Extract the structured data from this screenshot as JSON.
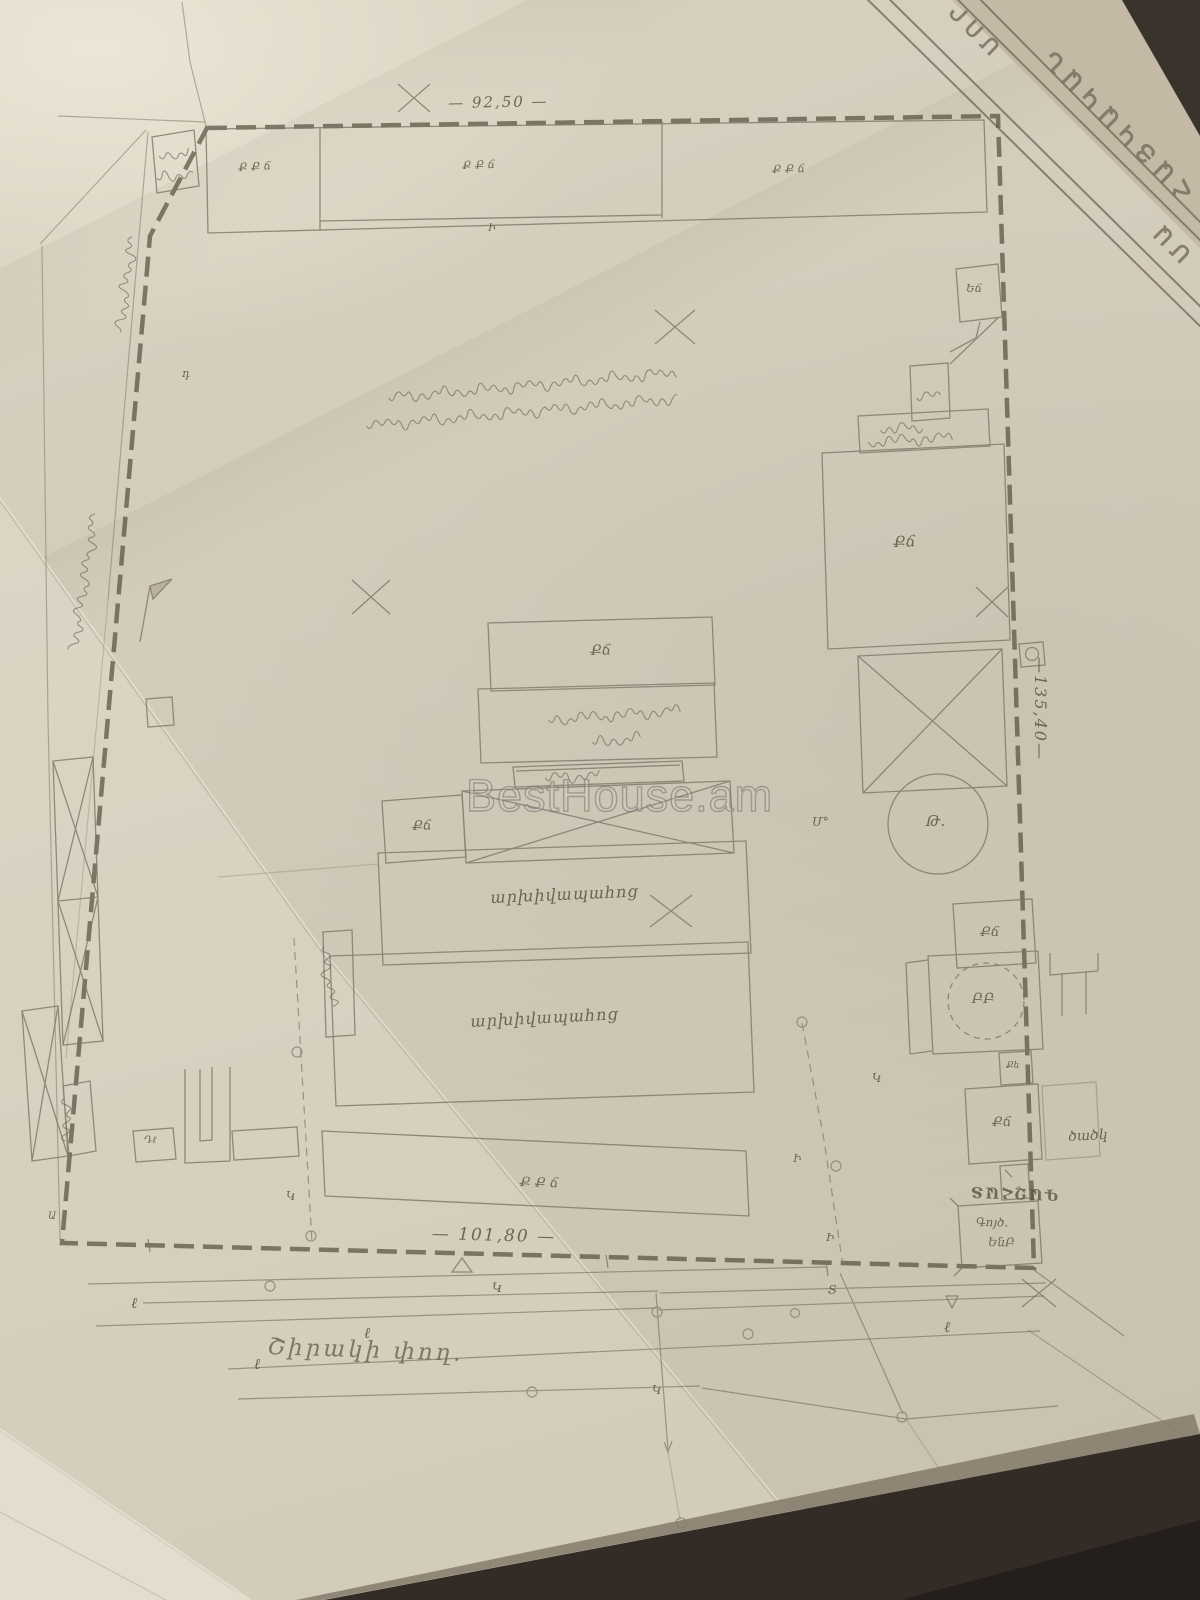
{
  "watermark": "BestHouse.am",
  "stamp_banner": {
    "fragment_top": "ՄՈՐ",
    "fragment_main": "ՀԱՅԿԱԿԱՆ",
    "fragment_edge": "ՄԱ"
  },
  "dimensions": {
    "top": "— 92,50 —",
    "right": "—135,40—",
    "bottom": "— 101,80 —"
  },
  "street_name": "Շիրակի  փող.",
  "plan_labels": {
    "strip_cell_1": "Ք Ք ճ",
    "strip_cell_2": "Ք Ք ճ",
    "strip_cell_3": "Ք Ք ճ",
    "strip_sub": "Ի",
    "center_building": "Քճ",
    "center_small_room": "Քճ",
    "right_big_room": "Քճ",
    "right_room_1": "Քճ",
    "right_room_2": "Քճ",
    "right_small_room": "Քե",
    "pump_circle": "Թ.",
    "meter_mark": "Մ°",
    "round_tank": "ԲԲ",
    "archive_hall_1": "արխիվապահոց",
    "archive_hall_2": "արխիվապահոց",
    "bottom_building": "Ք Ք ճ",
    "canopy": "ծածկ",
    "corner_booth": "Եճ",
    "gas_station": "ԳԱԶՀԱՏ",
    "substation_line1": "Գոյծ.",
    "substation_line2": "ԵնԲ",
    "small_shed": "Դℓ",
    "left_letter": "Ա",
    "road_letter": "դ"
  },
  "utility_letters": {
    "k1": "Կ",
    "k2": "Կ",
    "k3": "Կ",
    "k4": "Կ",
    "t1": "Տ",
    "l1": "ℓ",
    "l2": "ℓ",
    "l3": "ℓ",
    "l4": "ℓ",
    "i1": "Ի",
    "i2": "Ի"
  }
}
